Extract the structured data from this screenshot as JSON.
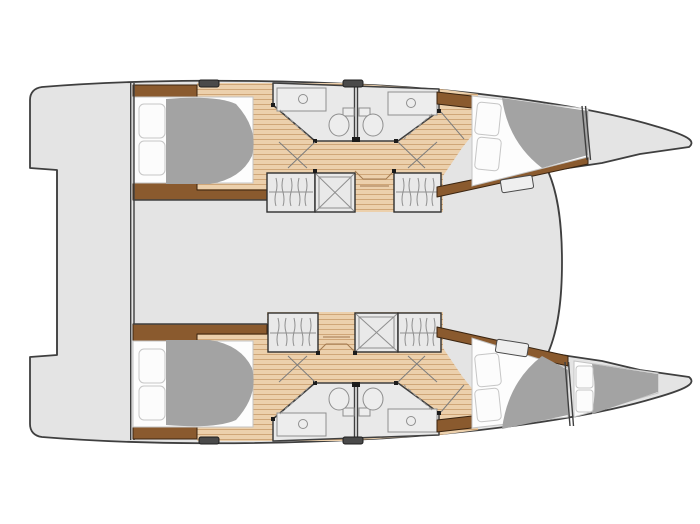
{
  "background": "#ffffff",
  "colors": {
    "background": "#ffffff",
    "hull": "#e4e4e4",
    "outline": "#3f3f3f",
    "wood": "#ecd0ac",
    "woodLine": "#cfa678",
    "trim": "#8a5a2e",
    "trimDark": "#3a2410",
    "duvet": "#a3a3a3",
    "mattress": "#fdfdfd",
    "bathFloor": "#e9e9e9",
    "hatch": "#4a4a4a"
  },
  "diagram": {
    "type": "catamaran-deck-plan",
    "view": "top-down interior layout",
    "hull_count": 2,
    "cabin_count": 4,
    "bathroom_count": 4,
    "bow_berth_count": 1,
    "areas": [
      "port-aft-cabin",
      "port-bathroom-aft",
      "port-bathroom-fwd",
      "port-fwd-cabin",
      "starboard-aft-cabin",
      "starboard-bathroom-aft",
      "starboard-bathroom-fwd",
      "starboard-fwd-cabin",
      "starboard-bow-berth",
      "saloon-bridgedeck",
      "aft-cockpit",
      "foredeck-trampoline"
    ],
    "fixtures": [
      "double-bed",
      "pillows",
      "duvet",
      "toilet",
      "sink-counter",
      "shower",
      "hanging-locker",
      "companionway-steps",
      "deck-hatch",
      "door-swing"
    ]
  }
}
